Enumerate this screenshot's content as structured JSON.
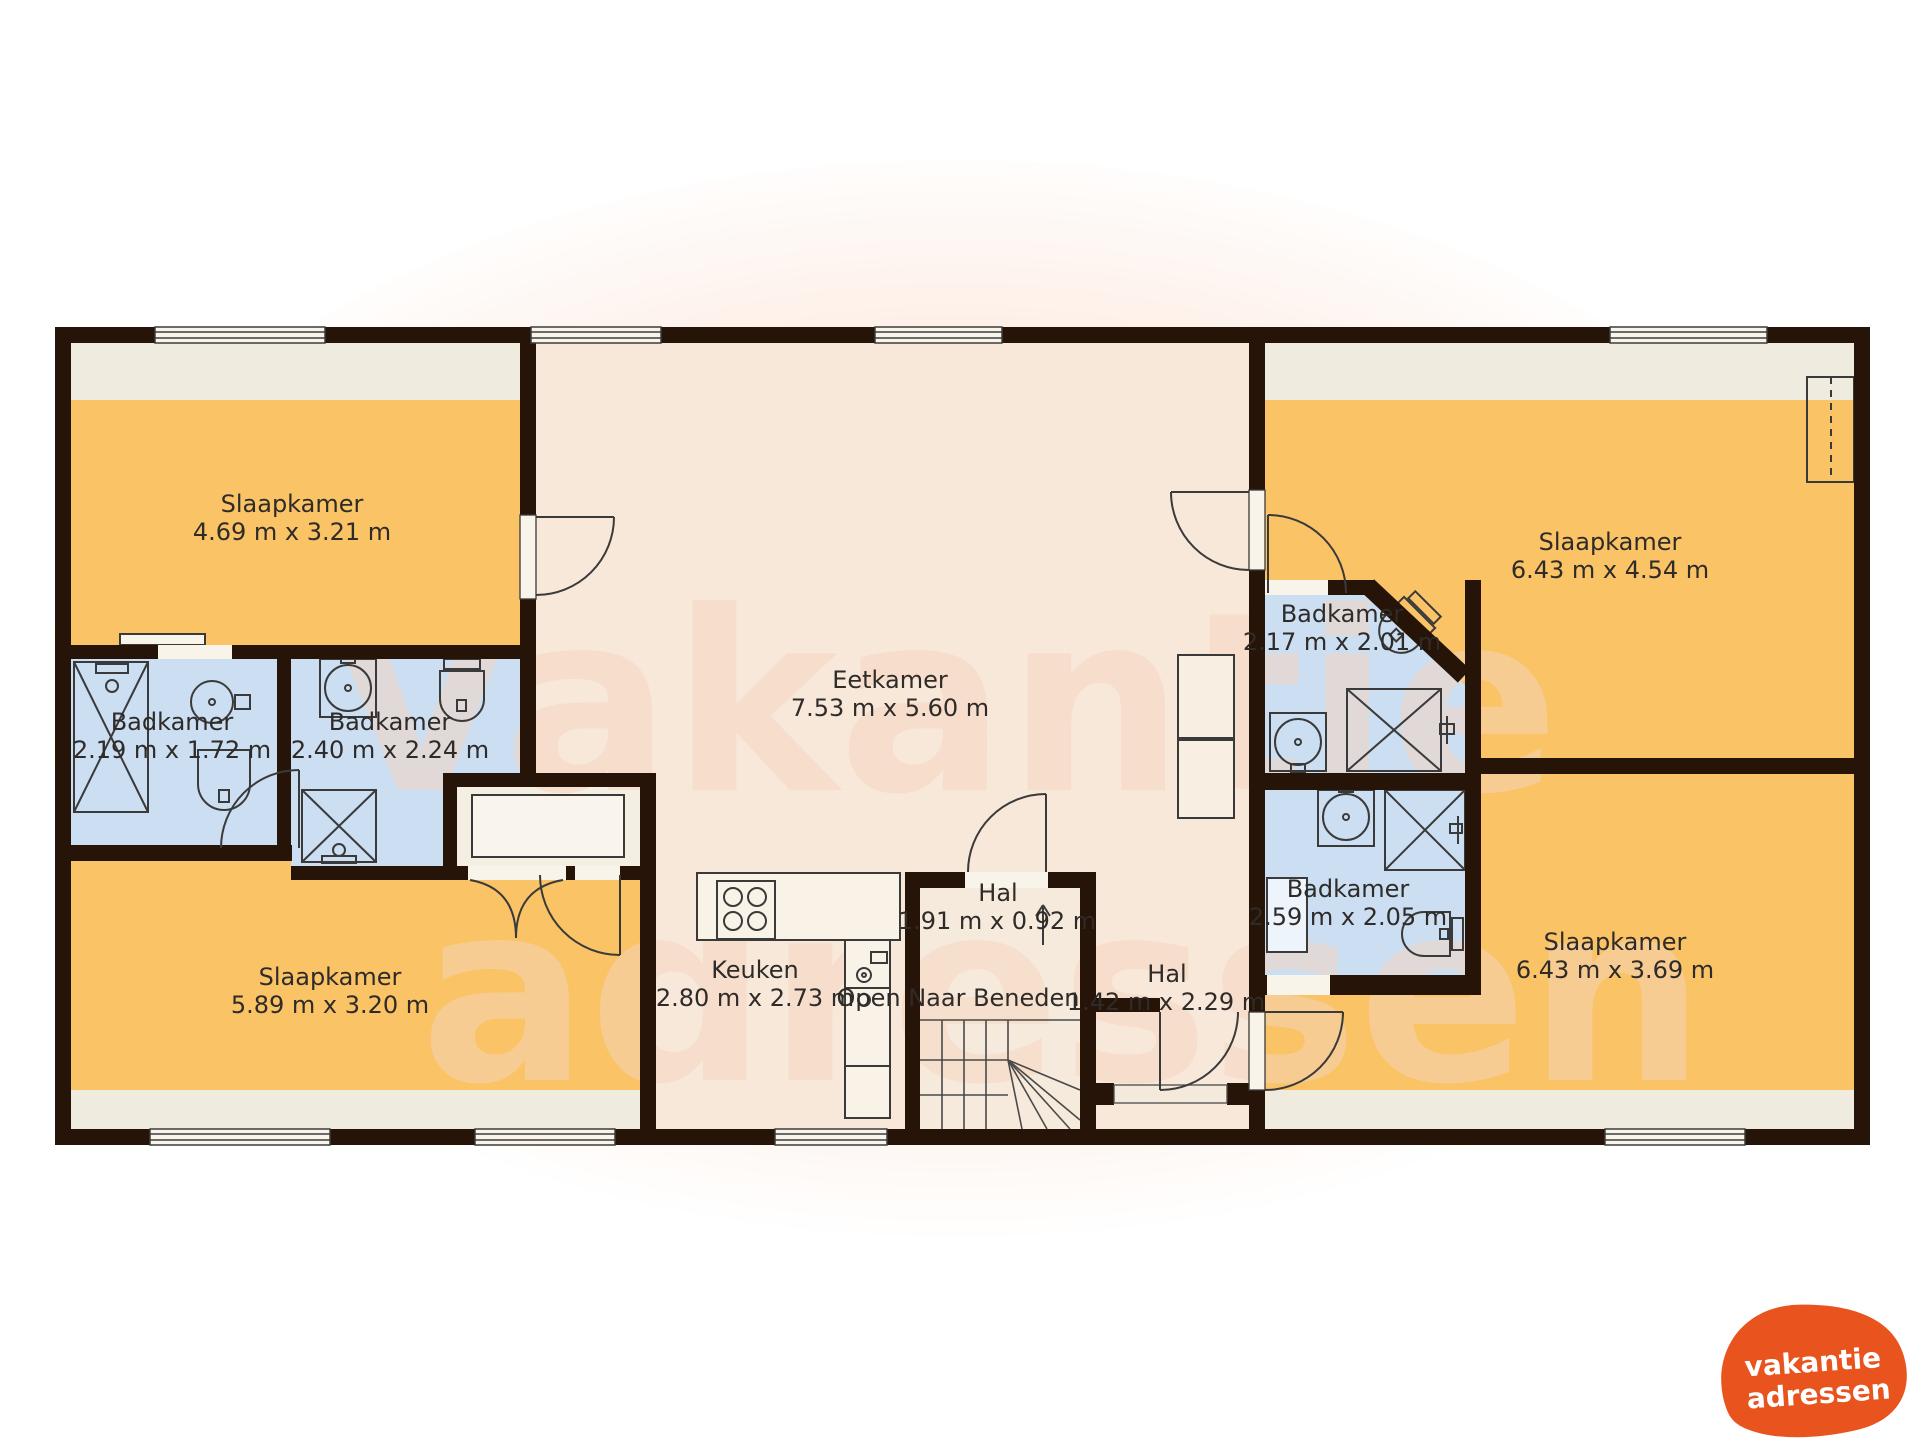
{
  "watermark": {
    "line1": "vakantie",
    "line2": "adressen"
  },
  "logo": {
    "line1": "vakantie",
    "line2": "adressen",
    "color": "#e8531e"
  },
  "rooms": {
    "bedroom_tl": {
      "name": "Slaapkamer",
      "dims": "4.69 m x 3.21 m"
    },
    "bedroom_bl": {
      "name": "Slaapkamer",
      "dims": "5.89 m x 3.20 m"
    },
    "bedroom_tr": {
      "name": "Slaapkamer",
      "dims": "6.43 m x 4.54 m"
    },
    "bedroom_br": {
      "name": "Slaapkamer",
      "dims": "6.43 m x 3.69 m"
    },
    "dining": {
      "name": "Eetkamer",
      "dims": "7.53 m x 5.60 m"
    },
    "kitchen": {
      "name": "Keuken",
      "dims": "2.80 m x 2.73 m"
    },
    "hall_stairs": {
      "name": "Hal",
      "dims": "1.91 m x 0.92 m"
    },
    "hall_right": {
      "name": "Hal",
      "dims": "1.42 m x 2.29 m"
    },
    "bath1": {
      "name": "Badkamer",
      "dims": "2.19 m x 1.72 m"
    },
    "bath2": {
      "name": "Badkamer",
      "dims": "2.40 m x 2.24 m"
    },
    "bath3": {
      "name": "Badkamer",
      "dims": "2.17 m x 2.01 m"
    },
    "bath4": {
      "name": "Badkamer",
      "dims": "2.59 m x 2.05 m"
    }
  },
  "stairs_note": "Open Naar Beneden",
  "colors": {
    "wall": "#271408",
    "bedroom": "#f9c366",
    "bathroom": "#cbdef2",
    "floor": "#f8e8da",
    "strip": "#f0ebdf",
    "logo_orange": "#e8531e"
  }
}
